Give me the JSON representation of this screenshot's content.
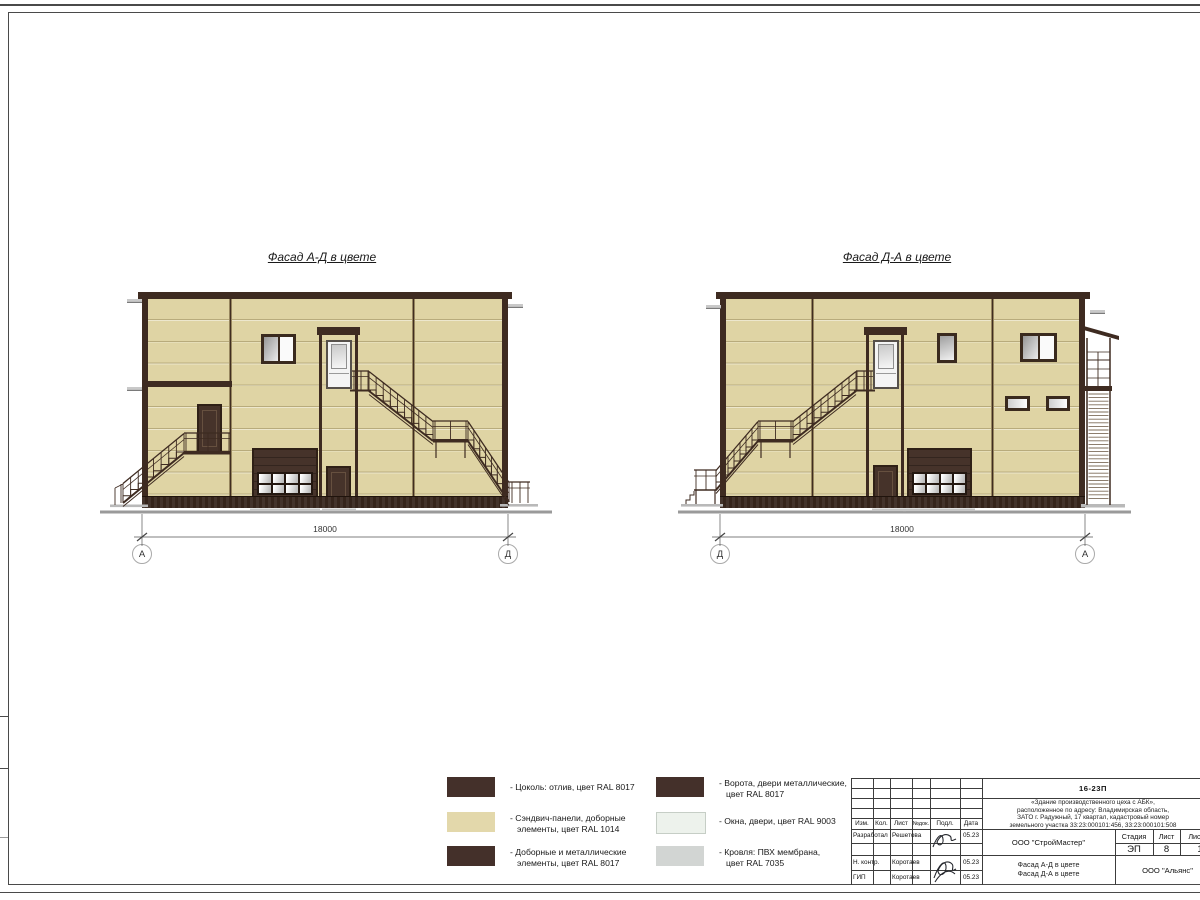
{
  "views": [
    {
      "title": "Фасад А-Д в цвете",
      "dimension": "18000",
      "axis_left": "А",
      "axis_right": "Д"
    },
    {
      "title": "Фасад Д-А в цвете",
      "dimension": "18000",
      "axis_left": "Д",
      "axis_right": "А"
    }
  ],
  "colors": {
    "panel": "#dfd4a4",
    "trim": "#3e2b21",
    "metal_door": "#46332a",
    "window_white": "#eef2ec",
    "roof_gray": "#d2d5d3"
  },
  "legend": [
    {
      "color": "#44302a",
      "lines": [
        "- Цоколь: отлив, цвет RAL 8017",
        ""
      ]
    },
    {
      "color": "#e3d8ab",
      "lines": [
        "- Сэндвич-панели, доборные",
        "элементы, цвет RAL 1014"
      ]
    },
    {
      "color": "#44302a",
      "lines": [
        "- Доборные и металлические",
        "элементы, цвет RAL 8017"
      ]
    },
    {
      "color": "#44302a",
      "lines": [
        "- Ворота, двери металлические,",
        "цвет RAL 8017"
      ]
    },
    {
      "color": "#edf2ec",
      "lines": [
        "- Окна, двери, цвет RAL 9003",
        ""
      ]
    },
    {
      "color": "#d2d5d3",
      "lines": [
        "- Кровля: ПВХ мембрана,",
        "цвет RAL 7035"
      ]
    }
  ],
  "title_block": {
    "doc_number": "16-23П",
    "project_lines": [
      "«Здание производственного цеха с АБК»,",
      "расположенное по адресу: Владимирская область,",
      "ЗАТО г. Радужный, 17 квартал, кадастровый номер",
      "земельного участка 33:23:000101:456, 33:23:000101:508"
    ],
    "header_cols": [
      "Изм.",
      "Кол.",
      "Лист",
      "№док.",
      "Подл.",
      "Дата"
    ],
    "rows": [
      {
        "role": "Разработал",
        "name": "Решетова",
        "date": "05.23"
      },
      {
        "role": "Н. контр.",
        "name": "Коротаев",
        "date": "05.23"
      },
      {
        "role": "ГИП",
        "name": "Коротаев",
        "date": "05.23"
      }
    ],
    "designer_org": "ООО \"СтройМастер\"",
    "stage_label": "Стадия",
    "sheet_label": "Лист",
    "sheets_label": "Листов",
    "stage": "ЭП",
    "sheet": "8",
    "sheets": "1",
    "doc_title_lines": [
      "Фасад А-Д в цвете",
      "Фасад Д-А в цвете"
    ],
    "client_org": "ООО \"Альянс\""
  }
}
